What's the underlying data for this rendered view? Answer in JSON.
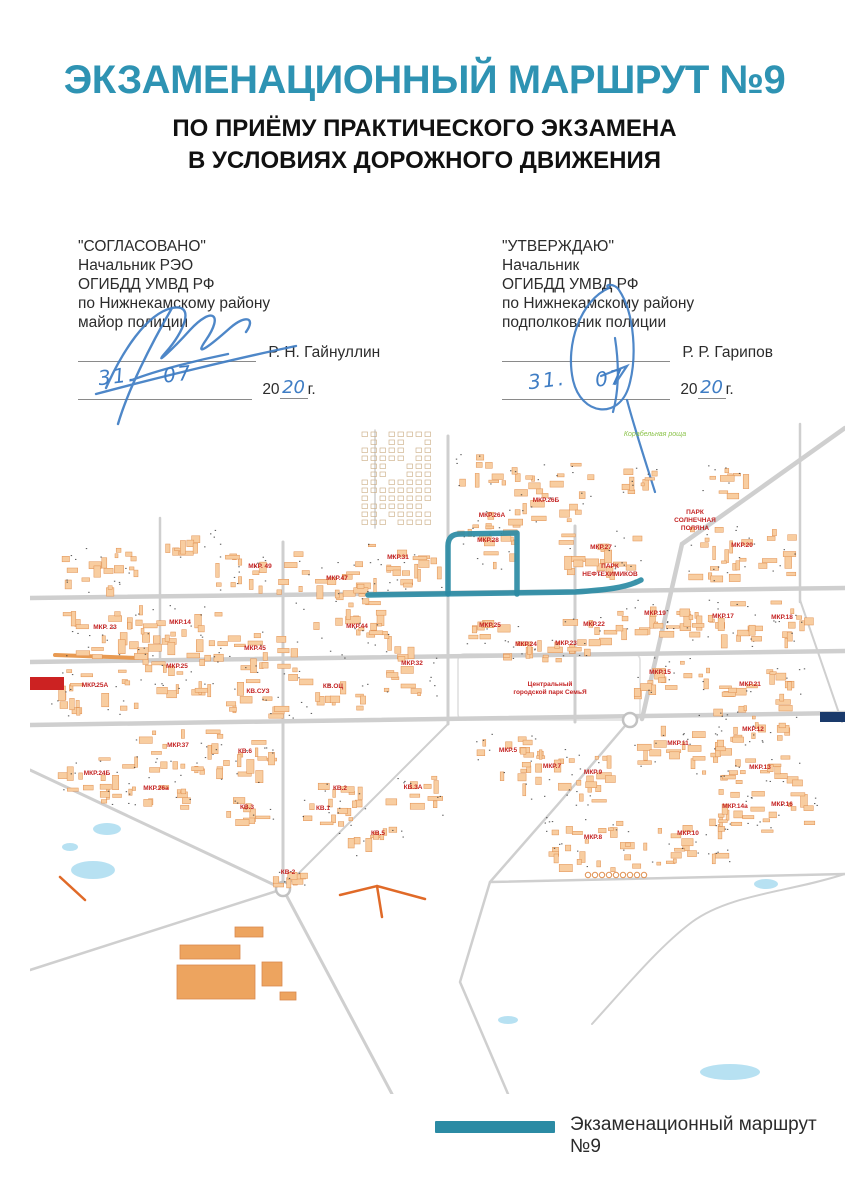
{
  "header": {
    "title": "ЭКЗАМЕНАЦИОННЫЙ МАРШРУТ №9",
    "subtitle1": "ПО ПРИЁМУ ПРАКТИЧЕСКОГО ЭКЗАМЕНА",
    "subtitle2": "В УСЛОВИЯХ ДОРОЖНОГО ДВИЖЕНИЯ"
  },
  "approvals": {
    "left": {
      "quote_title": "\"СОГЛАСОВАНО\"",
      "lines": [
        "Начальник РЭО",
        "ОГИБДД УМВД РФ",
        "по Нижнекамскому району",
        "майор полиции"
      ],
      "name": "Р. Н. Гайнуллин",
      "date_day": "31.",
      "date_month": "07",
      "year_prefix": "20",
      "year_handwritten": "20",
      "year_suffix": "г."
    },
    "right": {
      "quote_title": "\"УТВЕРЖДАЮ\"",
      "lines": [
        "Начальник",
        "ОГИБДД УМВД РФ",
        "по Нижнекамскому району",
        "подполковник полиции"
      ],
      "name": "Р. Р. Гарипов",
      "date_day": "31.",
      "date_month": "07",
      "year_prefix": "20",
      "year_handwritten": "20",
      "year_suffix": "г."
    }
  },
  "colors": {
    "title_teal": "#2e93b3",
    "route_teal": "#2b8ba4",
    "ink_blue": "#3f7dc4",
    "district_red": "#c42323",
    "building_fill": "#f8cda0",
    "building_stroke": "#e09050",
    "road_gray": "#cfcfcf"
  },
  "map": {
    "roads": [
      {
        "d": "M0,176 L815,166",
        "w": 4.5
      },
      {
        "d": "M0,240 L815,229",
        "w": 4.5
      },
      {
        "d": "M0,303 L815,291",
        "w": 4.5
      },
      {
        "d": "M130,96 L130,242",
        "w": 2.5
      },
      {
        "d": "M253,120 L253,467",
        "w": 3
      },
      {
        "d": "M418,14 L418,302",
        "w": 3
      },
      {
        "d": "M545,104 L545,300",
        "w": 3
      },
      {
        "d": "M770,2 L770,180",
        "w": 2.5
      },
      {
        "d": "M815,6 L652,122 L612,297",
        "w": 4.5
      },
      {
        "d": "M0,348 L253,467 L362,672",
        "w": 3
      },
      {
        "d": "M0,548 L253,467",
        "w": 2.5
      },
      {
        "d": "M253,467 L340,380 L418,302",
        "w": 2
      },
      {
        "d": "M600,298 L530,380 L460,460 L430,560 L478,672",
        "w": 2.5
      },
      {
        "d": "M460,460 L815,452",
        "w": 2.5
      },
      {
        "d": "M345,8 L345,106",
        "w": 1.5
      },
      {
        "d": "M770,178 L812,300",
        "w": 2
      },
      {
        "d": "M815,452 C760,470 700,472 662,500 C630,524 600,560 562,602",
        "w": 2
      }
    ],
    "accent_roads": [
      {
        "d": "M25,233 L108,236",
        "w": 4,
        "c": "#e89a52"
      },
      {
        "d": "M310,473 L347,464 L395,477",
        "w": 2.5,
        "c": "#e06a28"
      },
      {
        "d": "M347,464 L352,495",
        "w": 2.5,
        "c": "#e06a28"
      },
      {
        "d": "M30,455 L55,478",
        "w": 2.5,
        "c": "#e06a28"
      }
    ],
    "roundabouts": [
      {
        "x": 600,
        "y": 298
      },
      {
        "x": 253,
        "y": 467
      }
    ],
    "route": {
      "color": "#2b8ba4",
      "width": 5.5,
      "paths": [
        "M338,173 L545,170 C575,168 596,166 611,158",
        "M418,172 L418,124 Q418,112 430,112 L487,111 L487,172"
      ]
    },
    "districts": [
      {
        "label": "МКР. 49",
        "x": 230,
        "y": 146
      },
      {
        "label": "МКР.47",
        "x": 307,
        "y": 158
      },
      {
        "label": "МКР.31",
        "x": 368,
        "y": 137
      },
      {
        "label": "МКР.28",
        "x": 458,
        "y": 120,
        "w": 56,
        "h": 42
      },
      {
        "label": "МКР.26А",
        "x": 462,
        "y": 95,
        "w": 70,
        "h": 26
      },
      {
        "label": "МКР.26Б",
        "x": 516,
        "y": 80,
        "w": 80,
        "h": 28
      },
      {
        "label": "МКР.27",
        "x": 571,
        "y": 127
      },
      {
        "label": "МКР. 23",
        "x": 75,
        "y": 207
      },
      {
        "label": "МКР.14",
        "x": 150,
        "y": 202
      },
      {
        "label": "МКР.45",
        "x": 225,
        "y": 228
      },
      {
        "label": "МКР.44",
        "x": 327,
        "y": 206
      },
      {
        "label": "МКР.32",
        "x": 382,
        "y": 243,
        "w": 60
      },
      {
        "label": "МКР.25",
        "x": 147,
        "y": 246
      },
      {
        "label": "МКР.25А",
        "x": 65,
        "y": 265
      },
      {
        "label": "КВ.СУЗ",
        "x": 228,
        "y": 271,
        "w": 70,
        "h": 40
      },
      {
        "label": "КВ.ОЦ",
        "x": 303,
        "y": 266,
        "w": 70,
        "h": 40
      },
      {
        "label": "МКР.25",
        "x": 460,
        "y": 205,
        "w": 60,
        "h": 26
      },
      {
        "label": "МКР.24",
        "x": 496,
        "y": 224,
        "w": 50,
        "h": 24
      },
      {
        "label": "МКР.23",
        "x": 536,
        "y": 223,
        "w": 50,
        "h": 24
      },
      {
        "label": "МКР.22",
        "x": 564,
        "y": 204,
        "w": 70,
        "h": 30
      },
      {
        "label": "МКР.20",
        "x": 712,
        "y": 125,
        "w": 110,
        "h": 60
      },
      {
        "label": "МКР.19",
        "x": 625,
        "y": 193,
        "w": 80
      },
      {
        "label": "МКР.17",
        "x": 693,
        "y": 196,
        "w": 70
      },
      {
        "label": "МКР.18",
        "x": 752,
        "y": 197,
        "w": 70
      },
      {
        "label": "МКР.15",
        "x": 630,
        "y": 252,
        "w": 70,
        "h": 46
      },
      {
        "label": "МКР.21",
        "x": 720,
        "y": 264,
        "w": 110,
        "h": 50
      },
      {
        "label": "МКР.11",
        "x": 648,
        "y": 323
      },
      {
        "label": "МКР.12",
        "x": 723,
        "y": 309,
        "w": 80
      },
      {
        "label": "МКР.13",
        "x": 730,
        "y": 347,
        "w": 90
      },
      {
        "label": "МКР.5",
        "x": 478,
        "y": 330,
        "w": 70
      },
      {
        "label": "МКР.7",
        "x": 522,
        "y": 346,
        "w": 60
      },
      {
        "label": "МКР.9",
        "x": 563,
        "y": 352,
        "w": 60
      },
      {
        "label": "МКР.8",
        "x": 563,
        "y": 417,
        "w": 100,
        "h": 56
      },
      {
        "label": "МКР.10",
        "x": 658,
        "y": 413,
        "w": 90
      },
      {
        "label": "МКР.14а",
        "x": 705,
        "y": 386,
        "w": 60,
        "h": 30
      },
      {
        "label": "МКР.16",
        "x": 752,
        "y": 384,
        "w": 70,
        "h": 44
      },
      {
        "label": "МКР.37",
        "x": 148,
        "y": 325
      },
      {
        "label": "КВ.6",
        "x": 215,
        "y": 331,
        "w": 70
      },
      {
        "label": "МКР.24Б",
        "x": 67,
        "y": 353,
        "w": 80
      },
      {
        "label": "МКР.26а",
        "x": 126,
        "y": 368,
        "w": 70,
        "h": 36
      },
      {
        "label": "КВ.3",
        "x": 217,
        "y": 387,
        "w": 60,
        "h": 36
      },
      {
        "label": "КВ.1",
        "x": 293,
        "y": 388,
        "w": 60,
        "h": 36
      },
      {
        "label": "КВ.2",
        "x": 310,
        "y": 368,
        "w": 50,
        "h": 26
      },
      {
        "label": "КВ.3А",
        "x": 383,
        "y": 367,
        "w": 60,
        "h": 40
      },
      {
        "label": "КВ.5",
        "x": 348,
        "y": 413,
        "w": 60,
        "h": 36
      },
      {
        "label": "КВ-2",
        "x": 258,
        "y": 452,
        "w": 40,
        "h": 18
      }
    ],
    "parks": [
      {
        "lines": [
          "ПАРК",
          "СОЛНЕЧНАЯ",
          "ПОЛЯНА"
        ],
        "x": 665,
        "y": 92
      },
      {
        "lines": [
          "ПАРК",
          "НЕФТЕХИМИКОВ"
        ],
        "x": 580,
        "y": 146
      },
      {
        "lines": [
          "Центральный",
          "городской парк СемьЯ"
        ],
        "x": 520,
        "y": 264
      }
    ],
    "forest": {
      "label": "Корабельная роща",
      "x": 625,
      "y": 14
    }
  },
  "legend": {
    "label": "Экзаменационный маршрут №9",
    "bar_color": "#2b8ba4"
  }
}
